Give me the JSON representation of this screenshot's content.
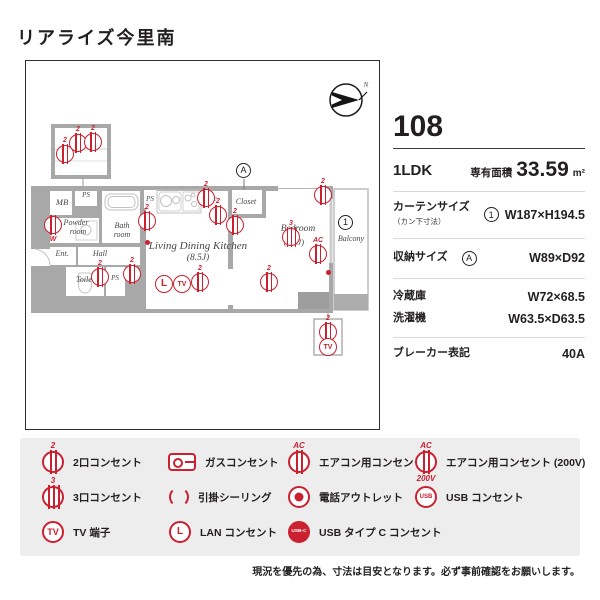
{
  "title": "リアライズ今里南",
  "info": {
    "unit": "108",
    "layout": "1LDK",
    "area_label": "専有面積",
    "area_value": "33.59",
    "area_unit": "m²",
    "curtain_label": "カーテンサイズ",
    "curtain_sub": "（カン下寸法）",
    "curtain_value": "W187×H194.5",
    "storage_label": "収納サイズ",
    "storage_value": "W89×D92",
    "fridge_label": "冷蔵庫",
    "fridge_value": "W72×68.5",
    "washer_label": "洗濯機",
    "washer_value": "W63.5×D63.5",
    "breaker_label": "ブレーカー表記",
    "breaker_value": "40A"
  },
  "glyphs": {
    "two": "2",
    "three": "3",
    "ac": "AC",
    "v200": "200V",
    "usb": "USB",
    "usbc": "USB-C",
    "tv": "TV",
    "lan": "L",
    "washer": "W",
    "north": "N",
    "marker_a": "A",
    "marker_1": "1"
  },
  "floorplan": {
    "labels": {
      "mb": "MB",
      "ps": "PS",
      "powder_1": "Powder",
      "powder_2": "room",
      "bath_1": "Bath",
      "bath_2": "room",
      "ent": "Ent.",
      "hall": "Hall",
      "toilet": "Toilet",
      "ps_small": "PS",
      "fridge": "F",
      "ldk": "Living Dining Kitchen",
      "ldk_size": "(8.5J)",
      "closet": "Closet",
      "bedroom": "Bedroom",
      "bedroom_size": "(5.3J)",
      "balcony": "Balcony"
    }
  },
  "legend": {
    "items": [
      {
        "icon": "outlet2",
        "label": "2口コンセント"
      },
      {
        "icon": "gas",
        "label": "ガスコンセント"
      },
      {
        "icon": "ac",
        "label": "エアコン用コンセント"
      },
      {
        "icon": "ac200",
        "label": "エアコン用コンセント (200V)"
      },
      {
        "icon": "outlet3",
        "label": "3口コンセント"
      },
      {
        "icon": "ceiling",
        "label": "引掛シーリング"
      },
      {
        "icon": "phone",
        "label": "電話アウトレット"
      },
      {
        "icon": "usb",
        "label": "USB コンセント"
      },
      {
        "icon": "tv",
        "label": "TV 端子"
      },
      {
        "icon": "lan",
        "label": "LAN コンセント"
      },
      {
        "icon": "usbc",
        "label": "USB タイプ C コンセント"
      }
    ]
  },
  "note": "現況を優先の為、寸法は目安となります。必ず事前確認をお願いします。",
  "colors": {
    "accent": "#cb2030",
    "wall": "#a8a8a8",
    "legend_bg": "#ededed"
  }
}
